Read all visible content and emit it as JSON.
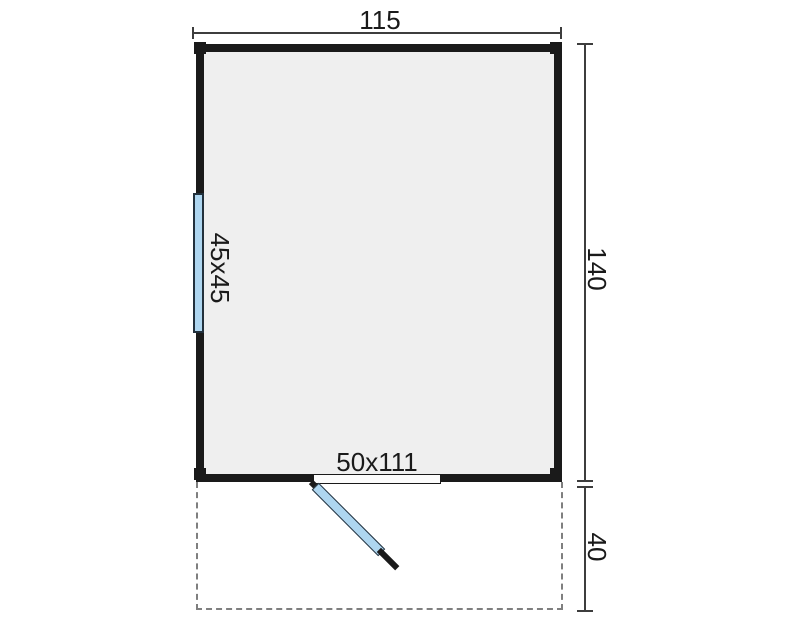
{
  "floorplan": {
    "building": {
      "width_dim": "115",
      "height_dim": "140"
    },
    "window": {
      "label": "45x45"
    },
    "door": {
      "label": "50x111"
    },
    "porch": {
      "depth_dim": "40"
    }
  },
  "colors": {
    "wall": "#1a1a1a",
    "floor": "#efefef",
    "glass": "#aed6f0",
    "glass_frame": "#22303c",
    "dim_line": "#3d3d3d",
    "dash": "#7f7f7f",
    "text": "#1a1a1a",
    "door_sill": "#fcfcfc"
  }
}
